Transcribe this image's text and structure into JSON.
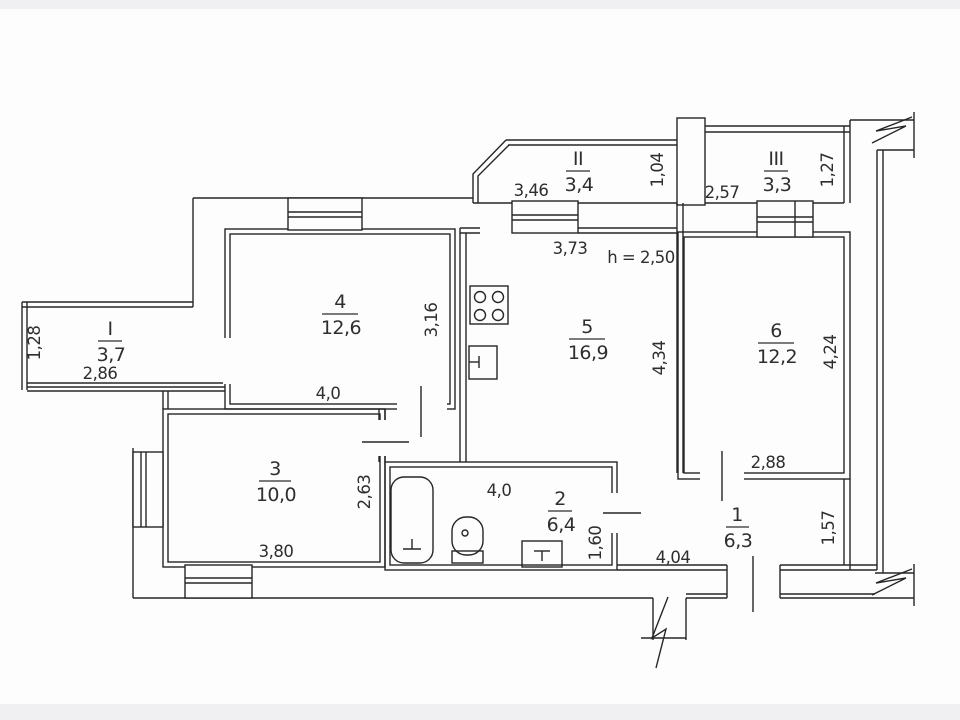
{
  "plan": {
    "rooms": [
      {
        "number": "1",
        "area": "6,3"
      },
      {
        "number": "2",
        "area": "6,4"
      },
      {
        "number": "3",
        "area": "10,0"
      },
      {
        "number": "4",
        "area": "12,6"
      },
      {
        "number": "5",
        "area": "16,9"
      },
      {
        "number": "6",
        "area": "12,2"
      },
      {
        "number": "I",
        "area": "3,7"
      },
      {
        "number": "II",
        "area": "3,4"
      },
      {
        "number": "III",
        "area": "3,3"
      }
    ],
    "dims": {
      "height_note": "h = 2,50",
      "b1_depth": "1,28",
      "b1_width": "2,86",
      "b2_width": "3,46",
      "b2_depth": "1,04",
      "b3_left": "2,57",
      "b3_depth": "1,27",
      "k_width": "3,73",
      "k_height": "4,34",
      "r4_width": "4,0",
      "r4_height": "3,16",
      "r6_width": "2,88",
      "r6_height": "4,24",
      "r3_width": "3,80",
      "r3_height": "2,63",
      "r2_width": "4,0",
      "r2_height": "1,60",
      "r1_width": "4,04",
      "r1_height": "1,57"
    },
    "fixtures": [
      "stove",
      "kitchen-sink",
      "bathtub",
      "toilet",
      "wash-basin"
    ],
    "line_color": "#262626"
  }
}
